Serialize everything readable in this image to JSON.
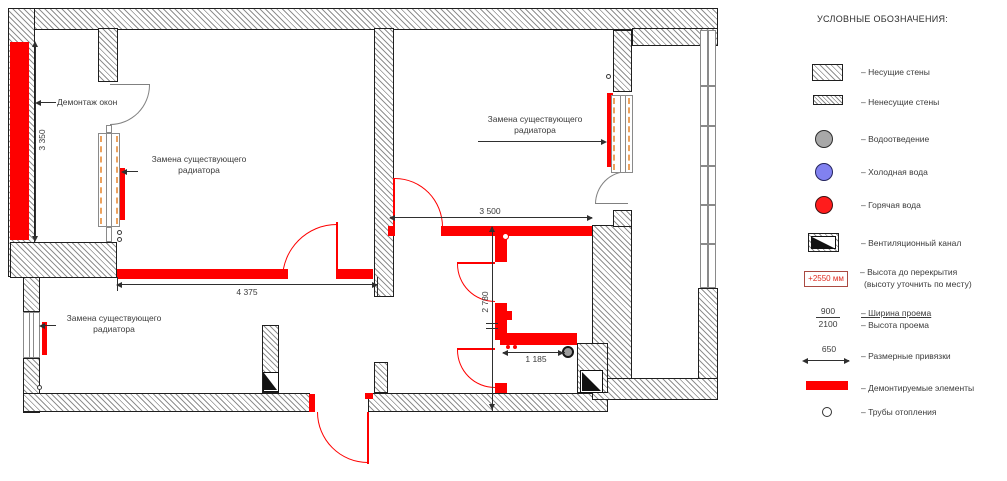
{
  "colors": {
    "demolition_red": "#fe0000",
    "cold_water_blue": "#8181f0",
    "hot_water_red": "#ff1c1c",
    "drainage_gray": "#a8a8a8",
    "window_frame_orange": "#eca25e"
  },
  "plan": {
    "annotations": {
      "demolish_windows": "Демонтаж окон",
      "replace_radiator_line1": "Замена существующего",
      "replace_radiator_line2": "радиатора"
    },
    "dimensions": {
      "loggia_height": "3 350",
      "living_width": "4 375",
      "bedroom_width": "3 500",
      "bath_depth": "2 780",
      "bath_width": "1 185"
    }
  },
  "legend": {
    "title": "УСЛОВНЫЕ ОБОЗНАЧЕНИЯ:",
    "items": [
      {
        "id": "bearing-walls",
        "label": "– Несущие стены"
      },
      {
        "id": "non-bearing-walls",
        "label": "– Ненесущие стены"
      },
      {
        "id": "drainage",
        "label": "– Водоотведение"
      },
      {
        "id": "cold-water",
        "label": "– Холодная вода"
      },
      {
        "id": "hot-water",
        "label": "– Горячая вода"
      },
      {
        "id": "vent-duct",
        "label": "– Вентиляционный канал"
      },
      {
        "id": "ceiling-height",
        "label": "– Высота до перекрытия",
        "label2": "(высоту уточнить по месту)",
        "value": "+2550 мм"
      },
      {
        "id": "opening-width",
        "label": "– Ширина проема",
        "value": "900"
      },
      {
        "id": "opening-height",
        "label": "– Высота проема",
        "value": "2100"
      },
      {
        "id": "dimension-ties",
        "label": "– Размерные привязки",
        "value": "650"
      },
      {
        "id": "demolished-elements",
        "label": "– Демонтируемые элементы"
      },
      {
        "id": "heating-pipes",
        "label": "– Трубы отопления"
      }
    ]
  }
}
